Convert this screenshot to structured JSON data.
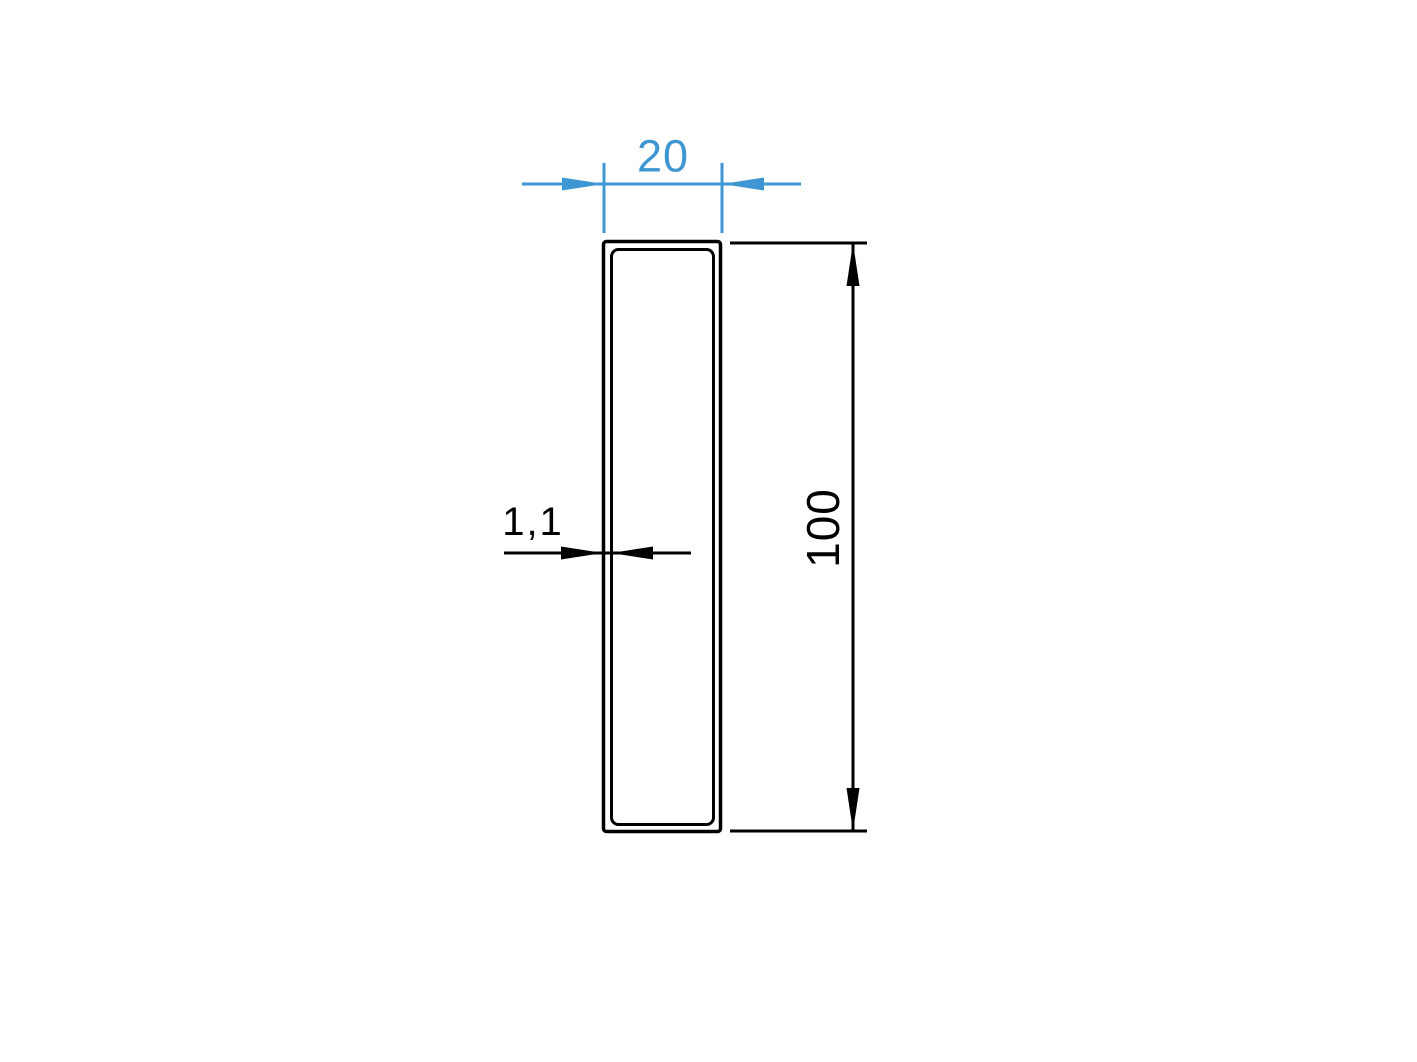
{
  "drawing": {
    "background_color": "#ffffff",
    "line_color": "#000000",
    "accent_color": "#3E96D2",
    "shape": "rectangular-tube-cross-section",
    "dimensions": {
      "width": {
        "value": "20",
        "color": "#3E96D2"
      },
      "height": {
        "value": "100",
        "color": "#000000"
      },
      "wall_thickness": {
        "value": "1,1",
        "color": "#000000"
      }
    }
  }
}
